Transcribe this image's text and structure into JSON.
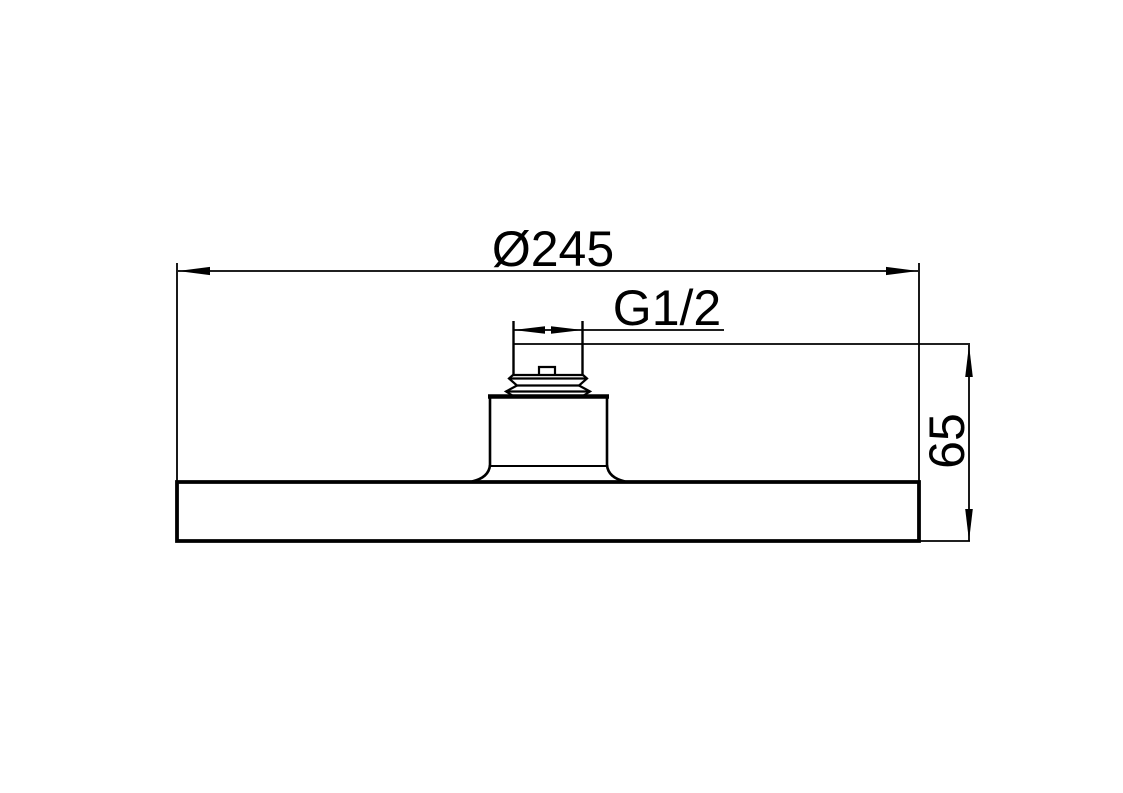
{
  "drawing": {
    "kind": "technical-dimension-drawing",
    "colors": {
      "line": "#000000",
      "background": "#ffffff"
    },
    "dimensions": {
      "diameter": {
        "label": "Ø245"
      },
      "thread": {
        "label": "G1/2"
      },
      "height": {
        "label": "65"
      }
    }
  }
}
